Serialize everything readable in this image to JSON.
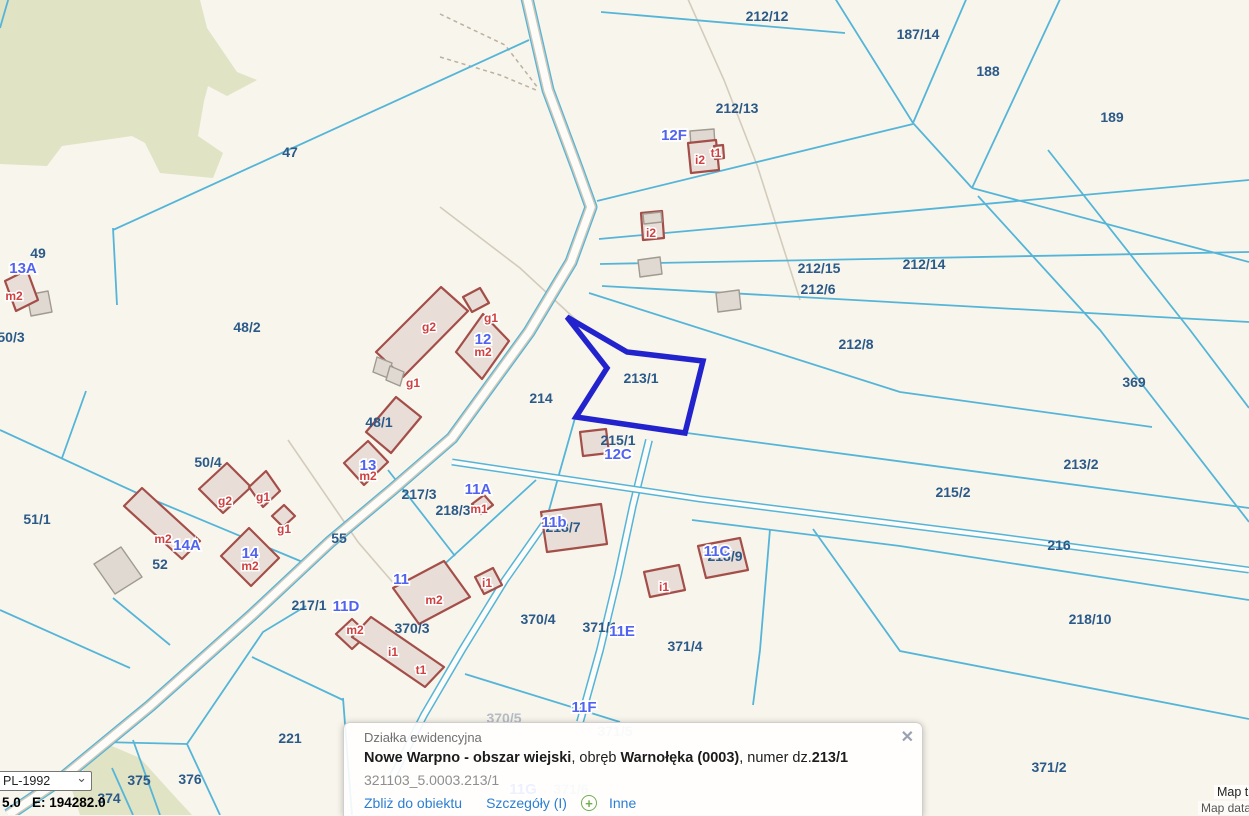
{
  "popup": {
    "title": "Działka ewidencyjna",
    "segments": [
      {
        "text": "Nowe Warpno - obszar wiejski",
        "bold": true
      },
      {
        "text": ", obręb ",
        "bold": false
      },
      {
        "text": "Warnołęka (0003)",
        "bold": true
      },
      {
        "text": ", numer dz.",
        "bold": false
      },
      {
        "text": "213/1",
        "bold": true
      }
    ],
    "id_line": "321103_5.0003.213/1",
    "links": {
      "zoom_to": "Zbliż do obiektu",
      "details": "Szczegóły (I)",
      "other": "Inne"
    }
  },
  "icons": {
    "close": "✕",
    "chevron_down": "⌄",
    "plus": "+"
  },
  "controls": {
    "crs_select": {
      "value": "PL-1992"
    },
    "coords_text": "5.0   E: 194282.0"
  },
  "attribution": {
    "line1": "Map ti",
    "line2": "Map data"
  },
  "map": {
    "selected_parcel": {
      "number": "213/1"
    },
    "colors": {
      "parcel_line": "#54b5d8",
      "selection": "#2323cd",
      "parcel_label": "#2b5a88",
      "address_label": "#5163ef",
      "building_label": "#cf4040",
      "road_fill": "#fdfcf8",
      "forest": "#e0e3c4",
      "background": "#f8f5ec"
    },
    "parcel_labels": [
      {
        "text": "212/12",
        "x": 767,
        "y": 21
      },
      {
        "text": "187/14",
        "x": 918,
        "y": 39
      },
      {
        "text": "188",
        "x": 988,
        "y": 76
      },
      {
        "text": "189",
        "x": 1112,
        "y": 122
      },
      {
        "text": "212/13",
        "x": 737,
        "y": 113
      },
      {
        "text": "47",
        "x": 290,
        "y": 157
      },
      {
        "text": "49",
        "x": 38,
        "y": 258
      },
      {
        "text": "50/3",
        "x": 11,
        "y": 342
      },
      {
        "text": "48/2",
        "x": 247,
        "y": 332
      },
      {
        "text": "212/15",
        "x": 819,
        "y": 273
      },
      {
        "text": "212/14",
        "x": 924,
        "y": 269
      },
      {
        "text": "212/6",
        "x": 818,
        "y": 294
      },
      {
        "text": "212/8",
        "x": 856,
        "y": 349
      },
      {
        "text": "369",
        "x": 1134,
        "y": 387
      },
      {
        "text": "214",
        "x": 541,
        "y": 403
      },
      {
        "text": "213/1",
        "x": 641,
        "y": 383
      },
      {
        "text": "48/1",
        "x": 379,
        "y": 427
      },
      {
        "text": "215/1",
        "x": 618,
        "y": 445
      },
      {
        "text": "213/2",
        "x": 1081,
        "y": 469
      },
      {
        "text": "215/2",
        "x": 953,
        "y": 497
      },
      {
        "text": "50/4",
        "x": 208,
        "y": 467
      },
      {
        "text": "51/1",
        "x": 37,
        "y": 524
      },
      {
        "text": "217/3",
        "x": 419,
        "y": 499
      },
      {
        "text": "218/3",
        "x": 453,
        "y": 515
      },
      {
        "text": "218/7",
        "x": 563,
        "y": 532
      },
      {
        "text": "55",
        "x": 339,
        "y": 543
      },
      {
        "text": "52",
        "x": 160,
        "y": 569
      },
      {
        "text": "216",
        "x": 1059,
        "y": 550
      },
      {
        "text": "218/9",
        "x": 725,
        "y": 561
      },
      {
        "text": "217/1",
        "x": 309,
        "y": 610
      },
      {
        "text": "370/3",
        "x": 412,
        "y": 633
      },
      {
        "text": "370/4",
        "x": 538,
        "y": 624
      },
      {
        "text": "371/1",
        "x": 600,
        "y": 632
      },
      {
        "text": "371/4",
        "x": 685,
        "y": 651
      },
      {
        "text": "218/10",
        "x": 1090,
        "y": 624
      },
      {
        "text": "221",
        "x": 290,
        "y": 743
      },
      {
        "text": "375",
        "x": 139,
        "y": 785
      },
      {
        "text": "376",
        "x": 190,
        "y": 784
      },
      {
        "text": "374",
        "x": 109,
        "y": 803
      },
      {
        "text": "371/2",
        "x": 1049,
        "y": 772
      }
    ],
    "muted_labels": [
      {
        "text": "370/5",
        "x": 504,
        "y": 723
      },
      {
        "text": "371/5",
        "x": 615,
        "y": 736
      },
      {
        "text": "371/6",
        "x": 571,
        "y": 794
      }
    ],
    "address_labels": [
      {
        "text": "13A",
        "x": 23,
        "y": 273
      },
      {
        "text": "12F",
        "x": 674,
        "y": 140
      },
      {
        "text": "12",
        "x": 483,
        "y": 344
      },
      {
        "text": "12C",
        "x": 618,
        "y": 459
      },
      {
        "text": "13",
        "x": 368,
        "y": 470
      },
      {
        "text": "14A",
        "x": 187,
        "y": 550
      },
      {
        "text": "14",
        "x": 250,
        "y": 558
      },
      {
        "text": "11A",
        "x": 478,
        "y": 494
      },
      {
        "text": "11b",
        "x": 554,
        "y": 527
      },
      {
        "text": "11C",
        "x": 717,
        "y": 556
      },
      {
        "text": "11",
        "x": 401,
        "y": 584
      },
      {
        "text": "11D",
        "x": 346,
        "y": 611
      },
      {
        "text": "11E",
        "x": 622,
        "y": 636
      },
      {
        "text": "11F",
        "x": 584,
        "y": 712
      },
      {
        "text": "11G",
        "x": 523,
        "y": 794
      }
    ],
    "building_labels": [
      {
        "text": "m2",
        "x": 14,
        "y": 300
      },
      {
        "text": "i2",
        "x": 700,
        "y": 164
      },
      {
        "text": "t1",
        "x": 716,
        "y": 157
      },
      {
        "text": "i2",
        "x": 651,
        "y": 237
      },
      {
        "text": "g2",
        "x": 429,
        "y": 331
      },
      {
        "text": "g1",
        "x": 491,
        "y": 322
      },
      {
        "text": "m2",
        "x": 483,
        "y": 356
      },
      {
        "text": "g1",
        "x": 413,
        "y": 387
      },
      {
        "text": "m2",
        "x": 368,
        "y": 480
      },
      {
        "text": "g2",
        "x": 225,
        "y": 505
      },
      {
        "text": "g1",
        "x": 263,
        "y": 501
      },
      {
        "text": "g1",
        "x": 284,
        "y": 533
      },
      {
        "text": "m2",
        "x": 163,
        "y": 543
      },
      {
        "text": "m2",
        "x": 250,
        "y": 570
      },
      {
        "text": "m1",
        "x": 479,
        "y": 513
      },
      {
        "text": "i1",
        "x": 487,
        "y": 587
      },
      {
        "text": "i1",
        "x": 664,
        "y": 591
      },
      {
        "text": "m2",
        "x": 434,
        "y": 604
      },
      {
        "text": "m2",
        "x": 355,
        "y": 634
      },
      {
        "text": "i1",
        "x": 393,
        "y": 656
      },
      {
        "text": "t1",
        "x": 421,
        "y": 674
      }
    ]
  }
}
